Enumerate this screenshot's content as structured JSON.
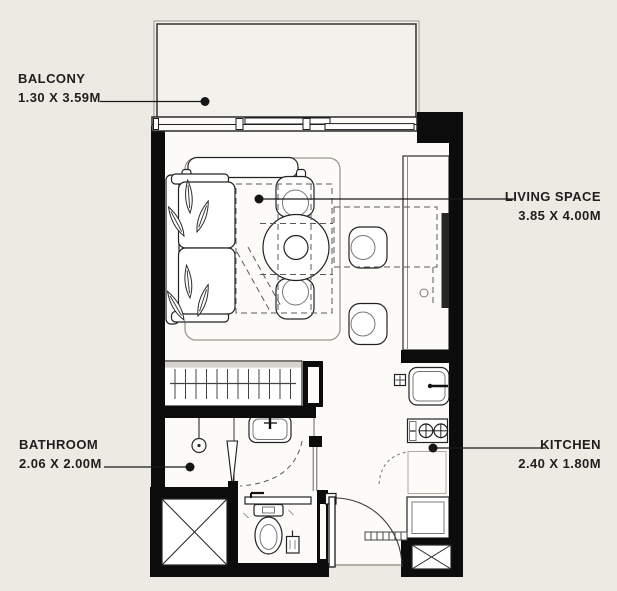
{
  "plan_title": "Studio apartment floor plan",
  "labels": {
    "balcony": {
      "name": "BALCONY",
      "dimensions": "1.30 X 3.59M"
    },
    "living": {
      "name": "LIVING SPACE",
      "dimensions": "3.85 X 4.00M"
    },
    "bathroom": {
      "name": "BATHROOM",
      "dimensions": "2.06 X 2.00M"
    },
    "kitchen": {
      "name": "KITCHEN",
      "dimensions": "2.40 X 1.80M"
    }
  },
  "colors": {
    "background": "#EDEAE4",
    "interior": "#FCFBF8",
    "balcony_floor": "#F3F1EB",
    "wall": "#0C0C0C",
    "label_text": "#1E1E1E"
  }
}
